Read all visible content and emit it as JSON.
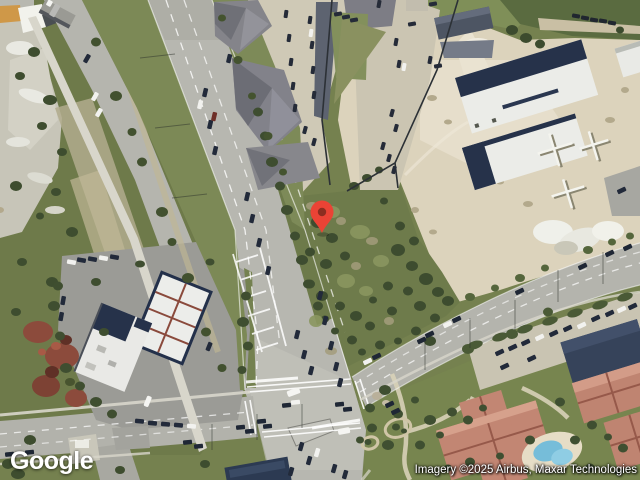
{
  "branding": {
    "logo_text": "Google"
  },
  "attribution": {
    "text": "Imagery ©2025 Airbus, Maxar Technologies"
  },
  "marker": {
    "transform": "translate(322,233)",
    "color": "#EA4335",
    "inner_color": "#8C2D20"
  },
  "theme": {
    "grass": "#75814f",
    "road": "#b7b7b0",
    "sand": "#dcd3bc",
    "navy_roof": "#26324a",
    "white_roof": "#ebece8",
    "salmon_roof": "#bf8471",
    "pool": "#76bdd9"
  }
}
